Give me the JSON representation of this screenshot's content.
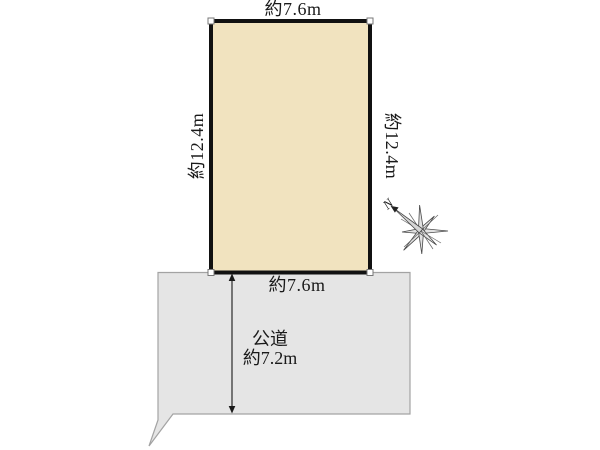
{
  "site_plan": {
    "lot": {
      "top_dimension": "約7.6m",
      "bottom_dimension": "約7.6m",
      "left_dimension": "約12.4m",
      "right_dimension": "約12.4m",
      "fill_color": "#f1e3bf",
      "border_color": "#111111"
    },
    "road": {
      "label_line1": "公道",
      "label_line2": "約7.2m",
      "fill_color": "#e5e5e5",
      "border_color": "#a3a3a3"
    },
    "compass": {
      "north_label": "N"
    },
    "text_color": "#1a1a1a",
    "background_color": "#ffffff"
  }
}
